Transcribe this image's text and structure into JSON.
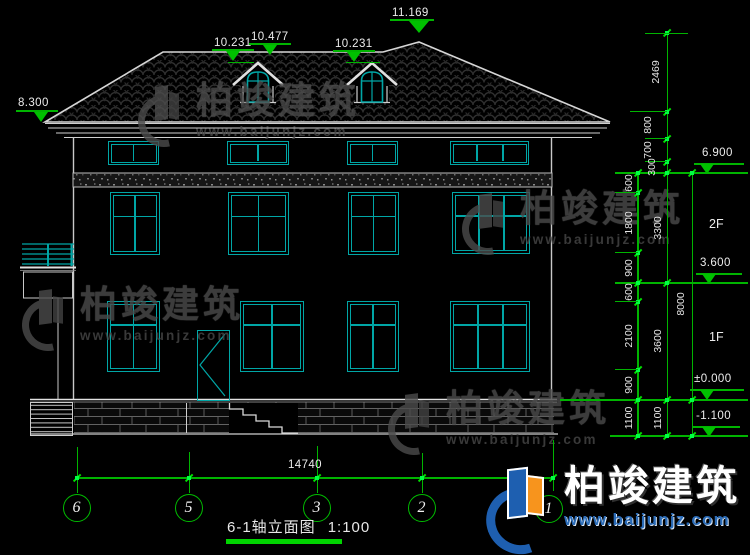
{
  "drawing": {
    "title": "6-1轴立面图",
    "scale": "1:100",
    "levels": {
      "eave_left": "8.300",
      "dormer_left_sill": "10.231",
      "dormer_left_peak": "10.477",
      "dormer_right_sill": "10.231",
      "ridge": "11.169",
      "right": [
        "6.900",
        "3.600",
        "±0.000",
        "-1.100"
      ]
    },
    "floor_labels": [
      "2F",
      "1F"
    ],
    "dims": {
      "chain_detail": [
        "600",
        "1800",
        "900",
        "600",
        "2100",
        "900",
        "1100"
      ],
      "chain_roof": [
        "2469",
        "800",
        "700",
        "300"
      ],
      "chain_floors": [
        "3300",
        "3600",
        "1100"
      ],
      "total_height": "8000",
      "total_width": "14740"
    },
    "grid_bubbles": [
      "6",
      "5",
      "3",
      "2",
      "1"
    ]
  },
  "watermark": {
    "brand": "柏竣建筑",
    "url": "www.baijunjz.com"
  },
  "logo": {
    "brand": "柏竣建筑",
    "url": "www.baijunjz.com"
  },
  "colors": {
    "dim_green": "#00c000",
    "cad_cyan": "#00a6a6",
    "logo_blue": "#1e5fb0",
    "logo_orange": "#f7941d"
  }
}
